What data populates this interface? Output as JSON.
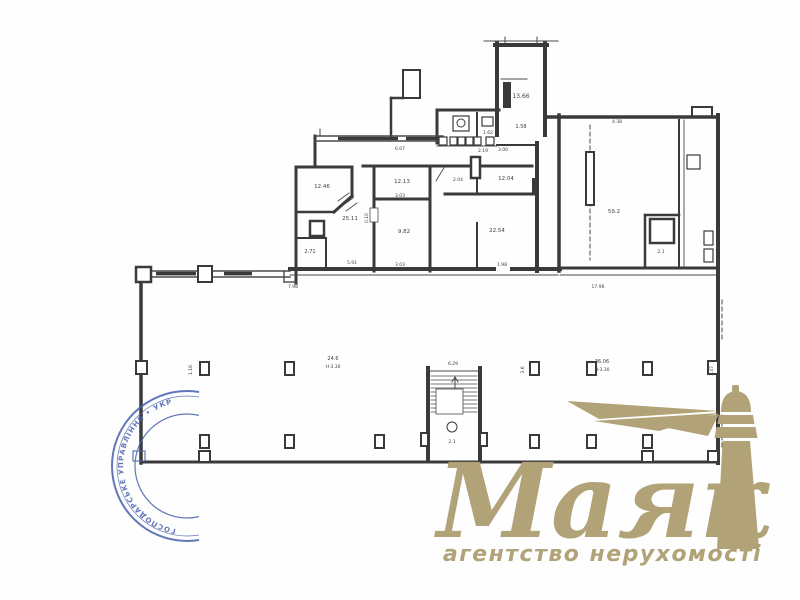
{
  "page": {
    "background": "#fefefe"
  },
  "logo": {
    "title": "Маяк",
    "subtitle": "агентство нерухомості",
    "color": "#b2a277"
  },
  "stamp": {
    "color": "#4660ad",
    "text": "ГОСПОДАРСЬКЕ УПРАВЛІННЯ • УКРАЇНА •"
  },
  "plan": {
    "stroke": "#3a3a3a",
    "thin_stroke": "#4a4a4a",
    "walls": [
      [
        497,
        43,
        497,
        135,
        4
      ],
      [
        545,
        43,
        545,
        135,
        4
      ],
      [
        495,
        45,
        547,
        45,
        4
      ],
      [
        437,
        110,
        499,
        110,
        3
      ],
      [
        437,
        110,
        437,
        143,
        3
      ],
      [
        477,
        113,
        477,
        139,
        2
      ],
      [
        315,
        136,
        315,
        167,
        3
      ],
      [
        296,
        167,
        352,
        167,
        3
      ],
      [
        296,
        167,
        296,
        283,
        3
      ],
      [
        352,
        167,
        352,
        196,
        3
      ],
      [
        352,
        196,
        334,
        212,
        3
      ],
      [
        298,
        212,
        334,
        212,
        2.5
      ],
      [
        296,
        238,
        326,
        238,
        2
      ],
      [
        326,
        238,
        326,
        268,
        2
      ],
      [
        363,
        166,
        532,
        166,
        3
      ],
      [
        374,
        168,
        374,
        271,
        3
      ],
      [
        374,
        199,
        430,
        199,
        3
      ],
      [
        430,
        166,
        430,
        271,
        3
      ],
      [
        445,
        194,
        537,
        194,
        3
      ],
      [
        477,
        170,
        477,
        194,
        2
      ],
      [
        477,
        223,
        477,
        266,
        2
      ],
      [
        537,
        143,
        537,
        271,
        4
      ],
      [
        559,
        115,
        559,
        271,
        3.5
      ],
      [
        497,
        145,
        537,
        145,
        2
      ],
      [
        290,
        269,
        494,
        269,
        4
      ],
      [
        512,
        269,
        560,
        269,
        4
      ],
      [
        545,
        117,
        716,
        117,
        3.5
      ],
      [
        692,
        107,
        692,
        117,
        2
      ],
      [
        692,
        107,
        712,
        107,
        2
      ],
      [
        712,
        107,
        712,
        117,
        2
      ],
      [
        679,
        120,
        679,
        268,
        2
      ],
      [
        718,
        115,
        718,
        463,
        4
      ],
      [
        645,
        215,
        679,
        215,
        2.5
      ],
      [
        645,
        215,
        645,
        268,
        2.5
      ],
      [
        560,
        268,
        718,
        268,
        3
      ],
      [
        141,
        270,
        141,
        463,
        3.5
      ],
      [
        141,
        462,
        718,
        462,
        3
      ],
      [
        391,
        98,
        391,
        137,
        2.5
      ],
      [
        391,
        98,
        403,
        98,
        2.5
      ],
      [
        428,
        368,
        428,
        461,
        4
      ],
      [
        480,
        368,
        480,
        461,
        4
      ]
    ],
    "thin": [
      [
        484,
        41,
        558,
        41,
        1
      ],
      [
        505,
        37,
        505,
        43,
        1
      ],
      [
        537,
        37,
        537,
        43,
        1
      ],
      [
        501,
        79,
        527,
        79,
        1
      ],
      [
        437,
        146,
        497,
        146,
        1
      ],
      [
        315,
        136,
        443,
        136,
        1.4
      ],
      [
        315,
        141,
        443,
        141,
        1.4
      ],
      [
        320,
        129,
        320,
        136,
        1
      ],
      [
        290,
        275,
        558,
        275,
        0.9
      ],
      [
        684,
        120,
        684,
        268,
        0.9
      ],
      [
        560,
        275,
        716,
        275,
        0.9
      ],
      [
        152,
        271,
        290,
        271,
        1.4
      ],
      [
        152,
        277,
        290,
        277,
        1.4
      ],
      [
        284,
        271,
        284,
        282,
        1.4
      ],
      [
        284,
        282,
        296,
        282,
        1.4
      ],
      [
        428,
        371,
        480,
        371,
        1
      ],
      [
        445,
        166,
        436,
        181,
        0.9
      ],
      [
        338,
        201,
        349,
        193,
        0.9
      ],
      [
        342,
        206,
        353,
        198,
        0.9
      ],
      [
        346,
        211,
        357,
        203,
        0.9
      ],
      [
        405,
        96,
        418,
        74,
        0.9
      ],
      [
        405,
        88,
        414,
        76,
        0.9
      ],
      [
        455,
        412,
        455,
        377,
        1
      ],
      [
        452,
        382,
        455,
        377,
        1
      ],
      [
        458,
        382,
        455,
        377,
        1
      ]
    ],
    "dashed": [
      [
        590,
        125,
        590,
        260
      ],
      [
        722,
        300,
        722,
        340
      ],
      [
        722,
        415,
        722,
        450
      ]
    ],
    "rects": [
      [
        403,
        70,
        17,
        28,
        2
      ],
      [
        310,
        221,
        14,
        15,
        2.5
      ],
      [
        471,
        157,
        9,
        21,
        2.5
      ],
      [
        586,
        152,
        8,
        53,
        2
      ],
      [
        650,
        219,
        24,
        24,
        2.5
      ],
      [
        136,
        267,
        15,
        15,
        2.5
      ],
      [
        198,
        266,
        14,
        16,
        2
      ],
      [
        687,
        155,
        13,
        14,
        1.2
      ],
      [
        704,
        231,
        9,
        14,
        1.2
      ],
      [
        704,
        249,
        9,
        13,
        1.2
      ],
      [
        453,
        116,
        16,
        15,
        1.2
      ],
      [
        482,
        117,
        11,
        9,
        1.2
      ],
      [
        200,
        362,
        9,
        13,
        2
      ],
      [
        285,
        362,
        9,
        13,
        2
      ],
      [
        530,
        362,
        9,
        13,
        2
      ],
      [
        587,
        362,
        9,
        13,
        2
      ],
      [
        643,
        362,
        9,
        13,
        2
      ],
      [
        136,
        361,
        11,
        13,
        2
      ],
      [
        708,
        361,
        10,
        13,
        2
      ],
      [
        200,
        435,
        9,
        13,
        2
      ],
      [
        285,
        435,
        9,
        13,
        2
      ],
      [
        375,
        435,
        9,
        13,
        2
      ],
      [
        530,
        435,
        9,
        13,
        2
      ],
      [
        587,
        435,
        9,
        13,
        2
      ],
      [
        643,
        435,
        9,
        13,
        2
      ],
      [
        199,
        451,
        11,
        11,
        2
      ],
      [
        642,
        451,
        11,
        11,
        2
      ],
      [
        708,
        451,
        10,
        11,
        2
      ],
      [
        421,
        433,
        7,
        13,
        2
      ],
      [
        480,
        433,
        7,
        13,
        2
      ],
      [
        439,
        137,
        8,
        8,
        1.2
      ],
      [
        450,
        137,
        7,
        8,
        1.2
      ],
      [
        458,
        137,
        7,
        8,
        1.2
      ],
      [
        466,
        137,
        7,
        8,
        1.2
      ],
      [
        474,
        137,
        7,
        8,
        1.2
      ],
      [
        486,
        137,
        8,
        8,
        1.2
      ]
    ],
    "white_rects": [
      [
        370,
        208,
        8,
        14,
        0.8
      ],
      [
        436,
        389,
        27,
        25,
        0.8
      ]
    ],
    "dark_rects": [
      [
        503,
        82,
        8,
        26
      ],
      [
        532,
        178,
        7,
        16
      ],
      [
        338,
        136.8,
        60,
        3.4
      ],
      [
        406,
        136.8,
        31,
        3.4
      ],
      [
        156,
        271.8,
        40,
        3.6
      ],
      [
        224,
        271.8,
        28,
        3.6
      ]
    ],
    "treads": {
      "x1": 431,
      "x2": 477,
      "y": 376,
      "step": 4,
      "count": 10
    },
    "circles": [
      [
        452,
        427,
        5,
        1
      ],
      [
        461,
        123,
        4,
        1
      ]
    ],
    "labels": [
      [
        "13.66",
        521,
        98,
        6
      ],
      [
        "1.58",
        521,
        128,
        5
      ],
      [
        "1.62",
        488,
        134,
        4.5
      ],
      [
        "12.46",
        322,
        188,
        5.5
      ],
      [
        "25.11",
        350,
        220,
        5.5
      ],
      [
        "2.71",
        310,
        253,
        5
      ],
      [
        "12.13",
        402,
        183,
        5.5
      ],
      [
        "9.82",
        404,
        233,
        5.5
      ],
      [
        "2.04",
        458,
        181,
        4.5
      ],
      [
        "12.04",
        506,
        180,
        5.5
      ],
      [
        "22.54",
        497,
        232,
        5.5
      ],
      [
        "59.2",
        614,
        213,
        5.5
      ],
      [
        "2.1",
        661,
        253,
        4.5
      ],
      [
        "24.6",
        333,
        360,
        5
      ],
      [
        "H-3.30",
        333,
        368,
        4.5
      ],
      [
        "36.06",
        602,
        363,
        5
      ],
      [
        "H-3.30",
        602,
        371,
        4.5
      ],
      [
        "17.96",
        598,
        288,
        4.5
      ],
      [
        "7.98",
        293,
        288,
        4.5
      ],
      [
        "4.38",
        617,
        123,
        4.5
      ],
      [
        "6.29",
        453,
        365,
        4.5
      ],
      [
        "2.1",
        452,
        443,
        4.5
      ],
      [
        "5.91",
        352,
        264,
        4.5
      ],
      [
        "3.03",
        400,
        197,
        4.5
      ],
      [
        "3.03",
        400,
        266,
        4.5
      ],
      [
        "1.98",
        502,
        266,
        4.5
      ],
      [
        "6.07",
        400,
        150,
        4.5
      ],
      [
        "2.19",
        483,
        152,
        4.5
      ],
      [
        "3.00",
        503,
        151,
        4.5
      ]
    ],
    "vlabels": [
      [
        "0.10",
        368,
        218
      ],
      [
        "1.16",
        192,
        370
      ],
      [
        "3.6",
        524,
        370
      ],
      [
        "3.47",
        713,
        371
      ]
    ]
  }
}
